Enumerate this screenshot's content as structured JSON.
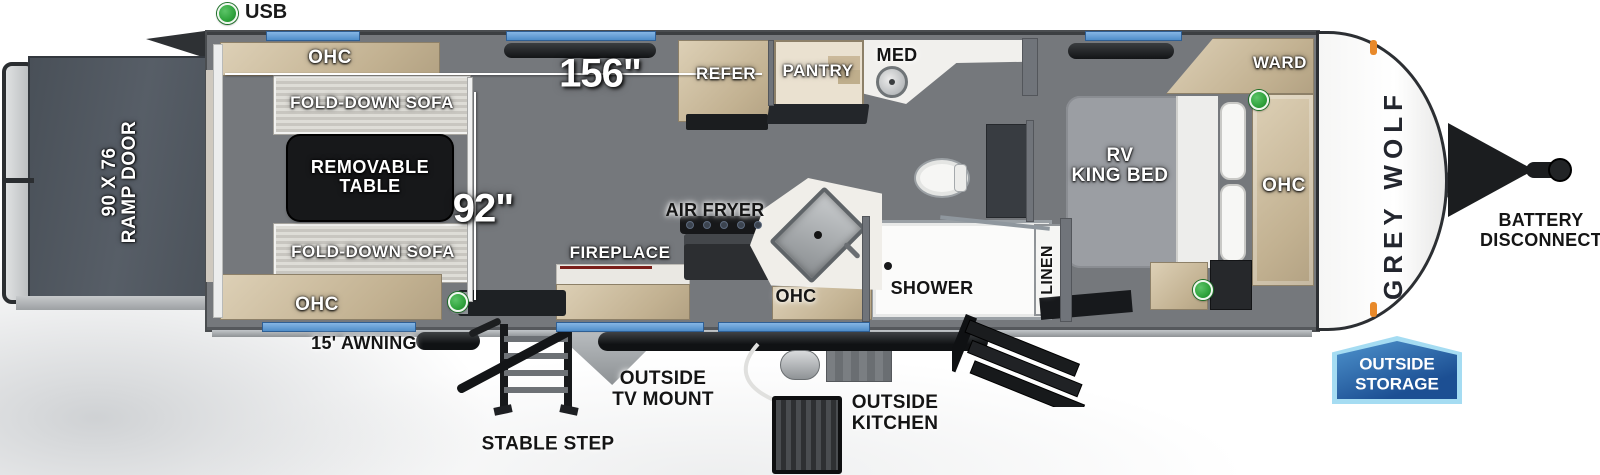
{
  "legend": {
    "usb": "USB"
  },
  "dims": {
    "length": "156\"",
    "width": "92\""
  },
  "exterior": {
    "ramp_door_line1": "90 X 76",
    "ramp_door_line2": "RAMP DOOR",
    "awning": "15' AWNING",
    "stable_step": "STABLE STEP",
    "tv_mount_line1": "OUTSIDE",
    "tv_mount_line2": "TV MOUNT",
    "kitchen_line1": "OUTSIDE",
    "kitchen_line2": "KITCHEN",
    "storage_line1": "OUTSIDE",
    "storage_line2": "STORAGE",
    "battery_line1": "BATTERY",
    "battery_line2": "DISCONNECT",
    "brand": "GREY WOLF"
  },
  "garage": {
    "ohc_top": "OHC",
    "sofa_top": "FOLD-DOWN SOFA",
    "table_line1": "REMOVABLE",
    "table_line2": "TABLE",
    "sofa_bottom": "FOLD-DOWN SOFA",
    "ohc_bottom": "OHC"
  },
  "kitchen": {
    "refer": "REFER",
    "pantry": "PANTRY",
    "air_fryer": "AIR FRYER",
    "fireplace": "FIREPLACE",
    "ohc": "OHC"
  },
  "bath": {
    "med": "MED",
    "shower": "SHOWER",
    "linen": "LINEN"
  },
  "bedroom": {
    "bed_line1": "RV",
    "bed_line2": "KING BED",
    "ward": "WARD",
    "ohc": "OHC"
  },
  "colors": {
    "window_blue": "#5d9bd3",
    "usb_green": "#2fa33c",
    "badge_blue": "#2a69ad",
    "wall_gray": "#70747a",
    "wood_tan": "#c9b795",
    "floor": "#d2ccc2"
  }
}
